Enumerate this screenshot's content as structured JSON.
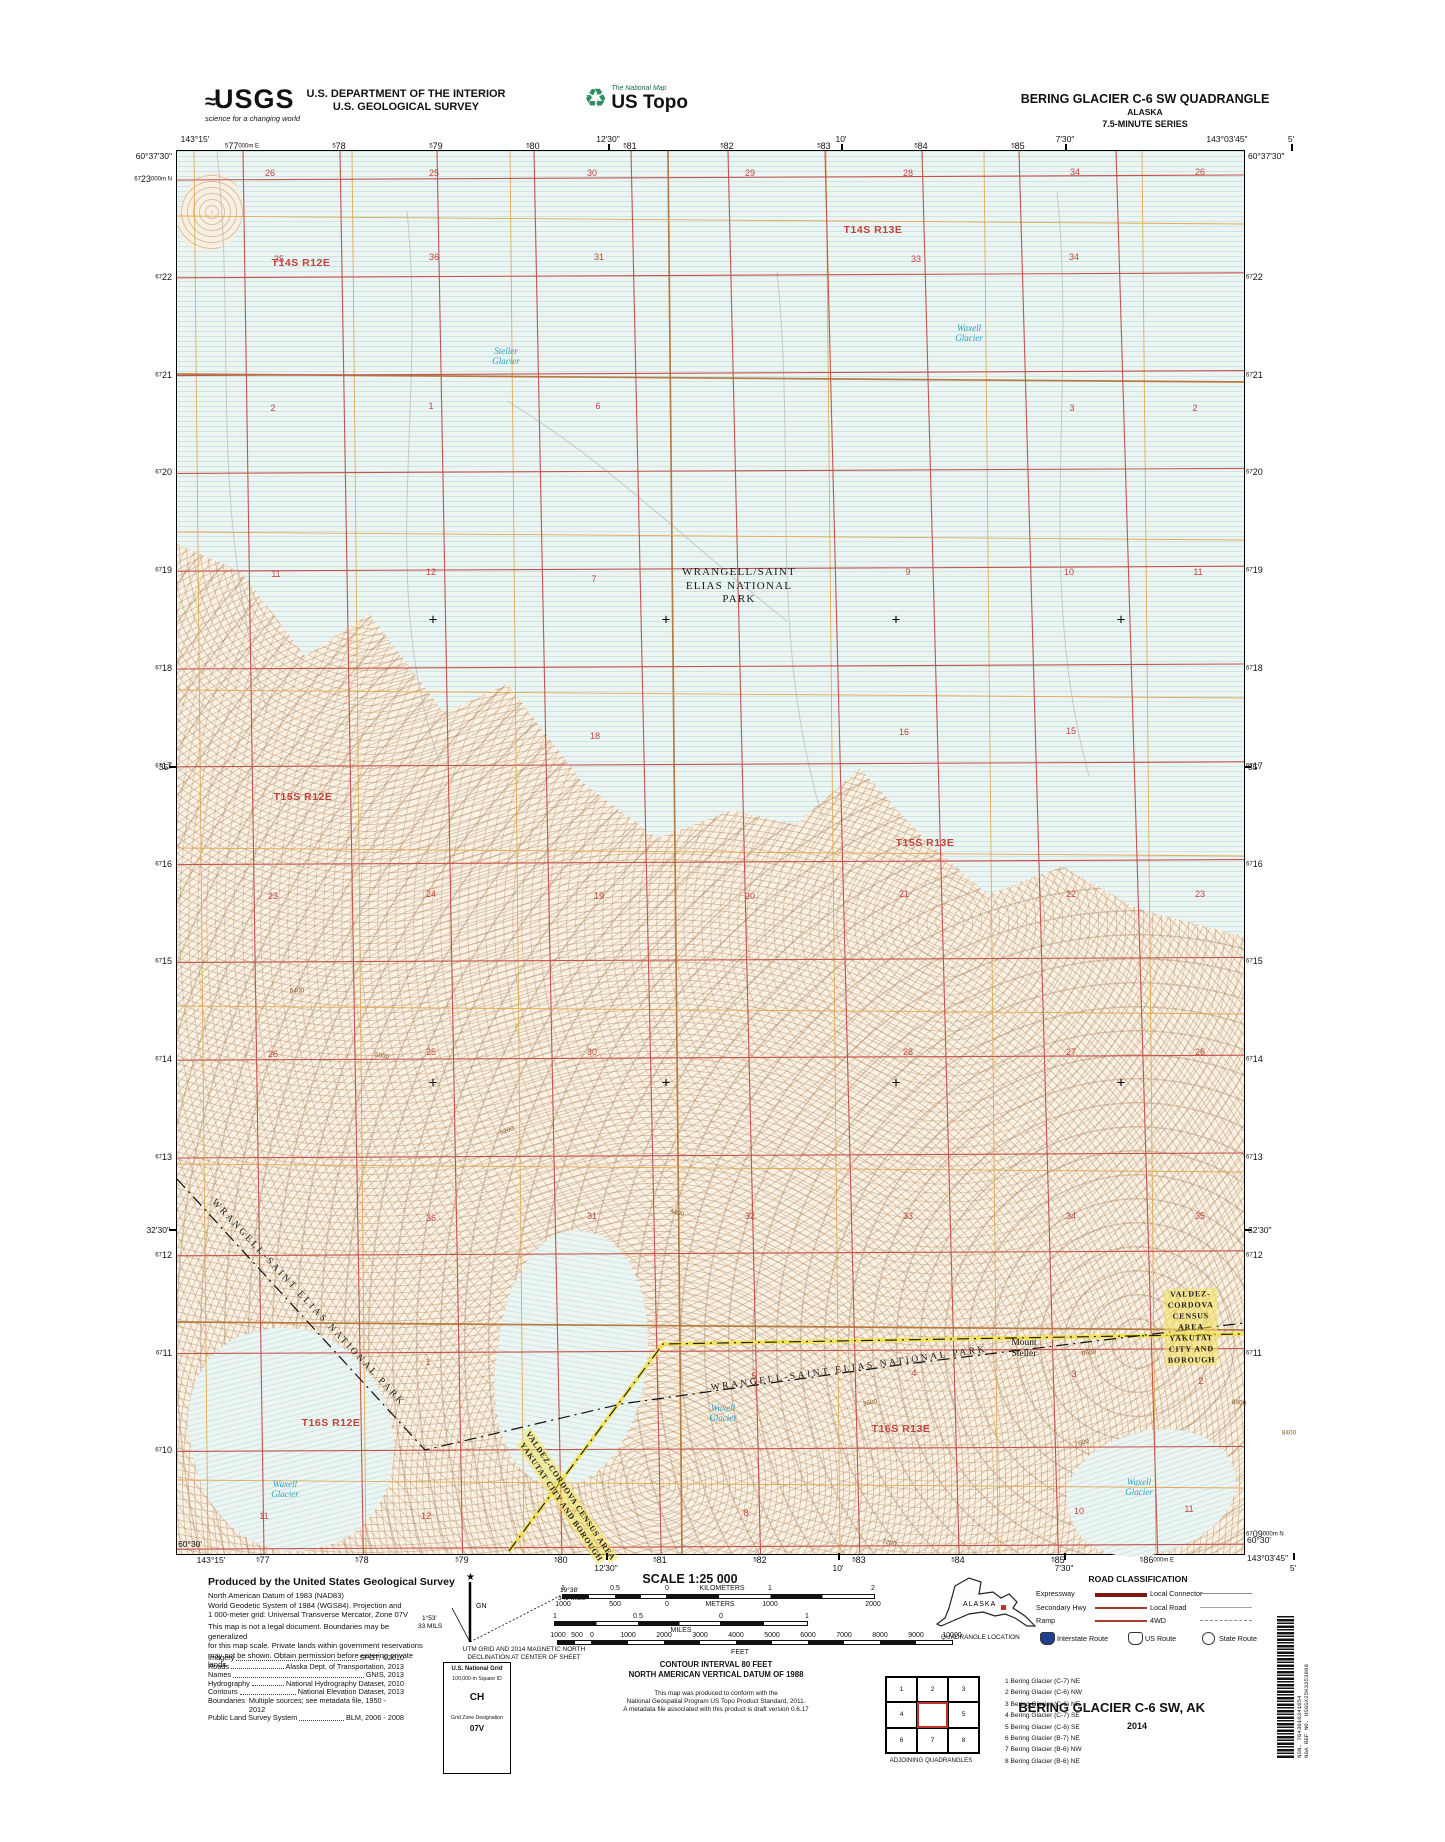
{
  "colors": {
    "grid_red": "#c4544e",
    "section_orange": "#e0a84f",
    "township_orange": "#b5763a",
    "water_cyan": "#2d9fbe",
    "boundary_yellow": "#f2e14c",
    "road_dark_red": "#7a1712",
    "road_red": "#a33c30",
    "interstate_blue": "#1f3f8f"
  },
  "header": {
    "usgs_word": "USGS",
    "usgs_wave": "≈",
    "usgs_tagline": "science for a changing world",
    "dept_line1": "U.S. DEPARTMENT OF THE INTERIOR",
    "dept_line2": "U.S. GEOLOGICAL SURVEY",
    "ustopo_icon": "♻",
    "ustopo_tagline": "The National Map",
    "ustopo_word": "US Topo",
    "quad_title": "BERING GLACIER C-6 SW QUADRANGLE",
    "quad_state": "ALASKA",
    "quad_series": "7.5-MINUTE SERIES"
  },
  "map": {
    "corners": {
      "tl_lon": "143°15'",
      "tl_lat": "60°37'30\"",
      "tr_lon": "143°03'45\"",
      "tr_lat": "60°37'30\"",
      "bl_lat": "60°30'",
      "bl_lon": "143°15'",
      "br_lat": "60°30'",
      "br_lon": "143°03'45\""
    },
    "top_lon": [
      {
        "t": "12'30\"",
        "x": 432
      },
      {
        "t": "10'",
        "x": 665
      },
      {
        "t": "7'30\"",
        "x": 889
      },
      {
        "t": "5'",
        "x": 1115
      }
    ],
    "bottom_lon": [
      {
        "t": "12'30\"",
        "x": 430
      },
      {
        "t": "10'",
        "x": 662
      },
      {
        "t": "7'30\"",
        "x": 888
      },
      {
        "t": "5'",
        "x": 1117
      }
    ],
    "left_lat": [
      {
        "t": "35'",
        "y": 616
      },
      {
        "t": "32'30\"",
        "y": 1079
      }
    ],
    "right_lat": [
      {
        "t": "35'",
        "y": 616
      },
      {
        "t": "32'30\"",
        "y": 1079
      }
    ],
    "top_eastings": [
      {
        "p": "5",
        "b": "77",
        "s": "000m E",
        "x": 242
      },
      {
        "p": "5",
        "b": "78",
        "x": 339
      },
      {
        "p": "5",
        "b": "79",
        "x": 436
      },
      {
        "p": "5",
        "b": "80",
        "x": 533
      },
      {
        "p": "5",
        "b": "81",
        "x": 630
      },
      {
        "p": "5",
        "b": "82",
        "x": 727
      },
      {
        "p": "5",
        "b": "83",
        "x": 824
      },
      {
        "p": "5",
        "b": "84",
        "x": 921
      },
      {
        "p": "5",
        "b": "85",
        "x": 1018
      }
    ],
    "bottom_eastings": [
      {
        "p": "5",
        "b": "77",
        "x": 263
      },
      {
        "p": "5",
        "b": "78",
        "x": 362
      },
      {
        "p": "5",
        "b": "79",
        "x": 462
      },
      {
        "p": "5",
        "b": "80",
        "x": 561
      },
      {
        "p": "5",
        "b": "81",
        "x": 660
      },
      {
        "p": "5",
        "b": "82",
        "x": 760
      },
      {
        "p": "5",
        "b": "83",
        "x": 859
      },
      {
        "p": "5",
        "b": "84",
        "x": 958
      },
      {
        "p": "5",
        "b": "85",
        "x": 1058
      },
      {
        "p": "5",
        "b": "86",
        "s": "000m E",
        "x": 1157
      }
    ],
    "left_northings": [
      {
        "p": "67",
        "b": "23",
        "s": "000m N",
        "y": 179
      },
      {
        "p": "67",
        "b": "22",
        "y": 277
      },
      {
        "p": "67",
        "b": "21",
        "y": 375
      },
      {
        "p": "67",
        "b": "20",
        "y": 472
      },
      {
        "p": "67",
        "b": "19",
        "y": 570
      },
      {
        "p": "67",
        "b": "18",
        "y": 668
      },
      {
        "p": "67",
        "b": "17",
        "y": 766
      },
      {
        "p": "67",
        "b": "16",
        "y": 864
      },
      {
        "p": "67",
        "b": "15",
        "y": 961
      },
      {
        "p": "67",
        "b": "14",
        "y": 1059
      },
      {
        "p": "67",
        "b": "13",
        "y": 1157
      },
      {
        "p": "67",
        "b": "12",
        "y": 1255
      },
      {
        "p": "67",
        "b": "11",
        "y": 1353
      },
      {
        "p": "67",
        "b": "10",
        "y": 1450
      }
    ],
    "right_northings": [
      {
        "p": "67",
        "b": "22",
        "y": 277
      },
      {
        "p": "67",
        "b": "21",
        "y": 375
      },
      {
        "p": "67",
        "b": "20",
        "y": 472
      },
      {
        "p": "67",
        "b": "19",
        "y": 570
      },
      {
        "p": "67",
        "b": "18",
        "y": 668
      },
      {
        "p": "67",
        "b": "17",
        "y": 766
      },
      {
        "p": "67",
        "b": "16",
        "y": 864
      },
      {
        "p": "67",
        "b": "15",
        "y": 961
      },
      {
        "p": "67",
        "b": "14",
        "y": 1059
      },
      {
        "p": "67",
        "b": "13",
        "y": 1157
      },
      {
        "p": "67",
        "b": "12",
        "y": 1255
      },
      {
        "p": "67",
        "b": "11",
        "y": 1353
      },
      {
        "p": "67",
        "b": "09",
        "s": "000m N",
        "y": 1534
      }
    ],
    "sections": [
      {
        "n": "26",
        "x": 93,
        "y": 22
      },
      {
        "n": "25",
        "x": 257,
        "y": 22
      },
      {
        "n": "30",
        "x": 415,
        "y": 22
      },
      {
        "n": "29",
        "x": 573,
        "y": 22
      },
      {
        "n": "28",
        "x": 731,
        "y": 22
      },
      {
        "n": "34",
        "x": 898,
        "y": 21
      },
      {
        "n": "26",
        "x": 1023,
        "y": 21
      },
      {
        "n": "35",
        "x": 102,
        "y": 108
      },
      {
        "n": "36",
        "x": 257,
        "y": 106
      },
      {
        "n": "31",
        "x": 422,
        "y": 106
      },
      {
        "n": "33",
        "x": 739,
        "y": 108
      },
      {
        "n": "34",
        "x": 897,
        "y": 106
      },
      {
        "n": "2",
        "x": 96,
        "y": 257
      },
      {
        "n": "1",
        "x": 254,
        "y": 255
      },
      {
        "n": "6",
        "x": 421,
        "y": 255
      },
      {
        "n": "3",
        "x": 895,
        "y": 257
      },
      {
        "n": "2",
        "x": 1018,
        "y": 257
      },
      {
        "n": "11",
        "x": 99,
        "y": 423
      },
      {
        "n": "12",
        "x": 254,
        "y": 421
      },
      {
        "n": "7",
        "x": 417,
        "y": 428
      },
      {
        "n": "9",
        "x": 731,
        "y": 421
      },
      {
        "n": "10",
        "x": 892,
        "y": 421
      },
      {
        "n": "11",
        "x": 1021,
        "y": 421
      },
      {
        "n": "18",
        "x": 418,
        "y": 585
      },
      {
        "n": "16",
        "x": 727,
        "y": 581
      },
      {
        "n": "15",
        "x": 894,
        "y": 580
      },
      {
        "n": "23",
        "x": 96,
        "y": 745
      },
      {
        "n": "24",
        "x": 254,
        "y": 743
      },
      {
        "n": "19",
        "x": 422,
        "y": 745
      },
      {
        "n": "20",
        "x": 573,
        "y": 745
      },
      {
        "n": "21",
        "x": 727,
        "y": 743
      },
      {
        "n": "22",
        "x": 894,
        "y": 743
      },
      {
        "n": "23",
        "x": 1023,
        "y": 743
      },
      {
        "n": "26",
        "x": 96,
        "y": 903
      },
      {
        "n": "25",
        "x": 254,
        "y": 901
      },
      {
        "n": "30",
        "x": 415,
        "y": 901
      },
      {
        "n": "28",
        "x": 731,
        "y": 901
      },
      {
        "n": "27",
        "x": 894,
        "y": 901
      },
      {
        "n": "26",
        "x": 1023,
        "y": 901
      },
      {
        "n": "36",
        "x": 254,
        "y": 1067
      },
      {
        "n": "31",
        "x": 415,
        "y": 1065
      },
      {
        "n": "32",
        "x": 573,
        "y": 1065
      },
      {
        "n": "33",
        "x": 731,
        "y": 1065
      },
      {
        "n": "34",
        "x": 894,
        "y": 1065
      },
      {
        "n": "35",
        "x": 1023,
        "y": 1065
      },
      {
        "n": "1",
        "x": 251,
        "y": 1211
      },
      {
        "n": "5",
        "x": 577,
        "y": 1225
      },
      {
        "n": "4",
        "x": 737,
        "y": 1222
      },
      {
        "n": "3",
        "x": 897,
        "y": 1223
      },
      {
        "n": "2",
        "x": 1024,
        "y": 1230
      },
      {
        "n": "11",
        "x": 87,
        "y": 1365
      },
      {
        "n": "12",
        "x": 249,
        "y": 1365
      },
      {
        "n": "7",
        "x": 397,
        "y": 1363
      },
      {
        "n": "8",
        "x": 569,
        "y": 1362
      },
      {
        "n": "10",
        "x": 902,
        "y": 1360
      },
      {
        "n": "11",
        "x": 1012,
        "y": 1358
      }
    ],
    "townships": [
      {
        "n": "T14S R12E",
        "x": 124,
        "y": 112
      },
      {
        "n": "T14S R13E",
        "x": 696,
        "y": 79
      },
      {
        "n": "T15S R12E",
        "x": 126,
        "y": 646
      },
      {
        "n": "T15S R13E",
        "x": 748,
        "y": 692
      },
      {
        "n": "T16S R12E",
        "x": 154,
        "y": 1272
      },
      {
        "n": "T16S R13E",
        "x": 724,
        "y": 1278
      }
    ],
    "park_label": {
      "lines": [
        "WRANGELL/SAINT",
        "ELIAS NATIONAL",
        "PARK"
      ],
      "x": 562,
      "y": 415
    },
    "park_diag": [
      {
        "t": "WRANGELL-SAINT ELIAS NATIONAL PARK",
        "x": 131,
        "y": 1152,
        "rot": 47
      },
      {
        "t": "WRANGELL-SAINT ELIAS NATIONAL PARK",
        "x": 672,
        "y": 1218,
        "rot": -8
      }
    ],
    "census_h": {
      "l1": "VALDEZ-CORDOVA CENSUS AREA",
      "l2": "YAKUTAT CITY AND BOROUGH",
      "x": 1014,
      "y": 1176,
      "rot": -1
    },
    "census_diag": {
      "l1": "VALDEZ-CORDOVA CENSUS AREA",
      "l2": "YAKUTAT CITY AND BOROUGH",
      "x": 389,
      "y": 1348,
      "rot": 56
    },
    "glaciers": [
      {
        "lines": [
          "Steller",
          "Glacier"
        ],
        "x": 329,
        "y": 205
      },
      {
        "lines": [
          "Waxell",
          "Glacier"
        ],
        "x": 792,
        "y": 182
      },
      {
        "lines": [
          "Waxell",
          "Glacier"
        ],
        "x": 546,
        "y": 1262
      },
      {
        "lines": [
          "Waxell",
          "Glacier"
        ],
        "x": 108,
        "y": 1338
      },
      {
        "lines": [
          "Waxell",
          "Glacier"
        ],
        "x": 962,
        "y": 1336
      }
    ],
    "mount": {
      "lines": [
        "Mount",
        "Steller"
      ],
      "x": 847,
      "y": 1198
    },
    "contours": [
      {
        "t": "3600",
        "x": 693,
        "y": 1252,
        "rot": -10
      },
      {
        "t": "4400",
        "x": 500,
        "y": 1062,
        "rot": 15
      },
      {
        "t": "5200",
        "x": 330,
        "y": 980,
        "rot": -20
      },
      {
        "t": "5800",
        "x": 205,
        "y": 905,
        "rot": 10
      },
      {
        "t": "6400",
        "x": 120,
        "y": 840,
        "rot": 0
      },
      {
        "t": "7600",
        "x": 905,
        "y": 1292,
        "rot": -15
      },
      {
        "t": "8800",
        "x": 1062,
        "y": 1252,
        "rot": 5
      },
      {
        "t": "8400",
        "x": 1112,
        "y": 1282,
        "rot": 0
      },
      {
        "t": "9600",
        "x": 912,
        "y": 1202,
        "rot": -8
      },
      {
        "t": "7200",
        "x": 712,
        "y": 1392,
        "rot": 12
      }
    ],
    "crosses": [
      {
        "x": 256,
        "y": 470
      },
      {
        "x": 489,
        "y": 470
      },
      {
        "x": 719,
        "y": 470
      },
      {
        "x": 944,
        "y": 470
      },
      {
        "x": 256,
        "y": 933
      },
      {
        "x": 489,
        "y": 933
      },
      {
        "x": 719,
        "y": 933
      },
      {
        "x": 944,
        "y": 933
      }
    ]
  },
  "footer": {
    "produced_by": "Produced by the United States Geological Survey",
    "credit_lines": [
      "North American Datum of 1983 (NAD83)",
      "World Geodetic System of 1984 (WGS84).  Projection and",
      "1 000-meter grid: Universal Transverse Mercator, Zone 07V"
    ],
    "disclaimer_lines": [
      "This map is not a legal document. Boundaries may be generalized",
      "for this map scale. Private lands within government reservations",
      "may not be shown. Obtain permission before entering private lands"
    ],
    "source_lines": [
      {
        "k": "Imagery",
        "v": "SPOT,  ©2010"
      },
      {
        "k": "Roads",
        "v": "Alaska Dept. of Transportation, 2013"
      },
      {
        "k": "Names",
        "v": "GNIS, 2013"
      },
      {
        "k": "Hydrography",
        "v": "National Hydrography Dataset, 2010"
      },
      {
        "k": "Contours",
        "v": "National Elevation Dataset, 2013"
      },
      {
        "k": "Boundaries",
        "v": "Multiple sources; see metadata file, 1950 - 2012"
      },
      {
        "k": "Public Land Survey System",
        "v": "BLM, 2006 - 2008"
      }
    ],
    "declination": {
      "gn": "GN",
      "star": "★",
      "utm_val": "1°53'",
      "utm_mils": "33 MILS",
      "mag_val": "19°38'",
      "mag_mils": "349 MILS",
      "cap1": "UTM GRID AND 2014 MAGNETIC NORTH",
      "cap2": "DECLINATION AT CENTER OF SHEET"
    },
    "usng": {
      "title": "U.S. National Grid",
      "sub": "100,000-m Square ID",
      "square": "CH",
      "zone_label": "Grid Zone Designation",
      "zone": "07V"
    },
    "scale_title": "SCALE 1:25 000",
    "scale_rows": {
      "km_marks": [
        {
          "t": "1",
          "x": 563
        },
        {
          "t": "0.5",
          "x": 615
        },
        {
          "t": "0",
          "x": 667
        },
        {
          "t": "KILOMETERS",
          "x": 722
        },
        {
          "t": "1",
          "x": 770
        },
        {
          "t": "2",
          "x": 873
        }
      ],
      "m_marks": [
        {
          "t": "1000",
          "x": 563
        },
        {
          "t": "500",
          "x": 615
        },
        {
          "t": "0",
          "x": 667
        },
        {
          "t": "METERS",
          "x": 720
        },
        {
          "t": "1000",
          "x": 770
        },
        {
          "t": "2000",
          "x": 873
        }
      ],
      "mi_marks": [
        {
          "t": "1",
          "x": 555
        },
        {
          "t": "0.5",
          "x": 638
        },
        {
          "t": "0",
          "x": 721
        },
        {
          "t": "1",
          "x": 807
        }
      ],
      "mi_word": "MILES",
      "ft_marks": [
        {
          "t": "1000",
          "x": 558
        },
        {
          "t": "500",
          "x": 577
        },
        {
          "t": "0",
          "x": 592
        },
        {
          "t": "1000",
          "x": 628
        },
        {
          "t": "2000",
          "x": 664
        },
        {
          "t": "3000",
          "x": 700
        },
        {
          "t": "4000",
          "x": 736
        },
        {
          "t": "5000",
          "x": 772
        },
        {
          "t": "6000",
          "x": 808
        },
        {
          "t": "7000",
          "x": 844
        },
        {
          "t": "8000",
          "x": 880
        },
        {
          "t": "9000",
          "x": 916
        },
        {
          "t": "10000",
          "x": 952
        }
      ],
      "ft_word": "FEET"
    },
    "contour_note1": "CONTOUR INTERVAL 80 FEET",
    "contour_note2": "NORTH AMERICAN VERTICAL DATUM OF 1988",
    "conformance": [
      "This map was produced to conform with the",
      "National Geospatial Program US Topo Product Standard, 2011.",
      "A metadata file associated with this product is draft version 0.6.17"
    ],
    "quad_location": {
      "state": "ALASKA",
      "caption": "QUADRANGLE LOCATION"
    },
    "roads": {
      "title": "ROAD CLASSIFICATION",
      "left": [
        {
          "label": "Expressway",
          "style": "expressway"
        },
        {
          "label": "Secondary Hwy",
          "style": "secondary"
        },
        {
          "label": "Ramp",
          "style": "ramp"
        }
      ],
      "right": [
        {
          "label": "Local Connector",
          "style": "connector"
        },
        {
          "label": "Local Road",
          "style": "local"
        },
        {
          "label": "4WD",
          "style": "fourwd"
        }
      ],
      "shields": [
        {
          "label": "Interstate Route",
          "type": "interstate"
        },
        {
          "label": "US Route",
          "type": "us"
        },
        {
          "label": "State Route",
          "type": "state"
        }
      ]
    },
    "adjoining": {
      "caption": "ADJOINING QUADRANGLES",
      "cells": [
        "1",
        "2",
        "3",
        "4",
        "",
        "5",
        "6",
        "7",
        "8"
      ],
      "list": [
        "1 Bering Glacier (C-7) NE",
        "2 Bering Glacier (C-6) NW",
        "3 Bering Glacier (C-6) NE",
        "4 Bering Glacier (C-7) SE",
        "5 Bering Glacier (C-6) SE",
        "6 Bering Glacier (B-7) NE",
        "7 Bering Glacier (B-6) NW",
        "8 Bering Glacier (B-6) NE"
      ]
    },
    "sheet_title": "BERING GLACIER C-6 SW, AK",
    "sheet_year": "2014",
    "barcode_nsn": "NSN.  7643016341654",
    "barcode_nga": "NGA REF NO.  USGSX25K3353888"
  }
}
